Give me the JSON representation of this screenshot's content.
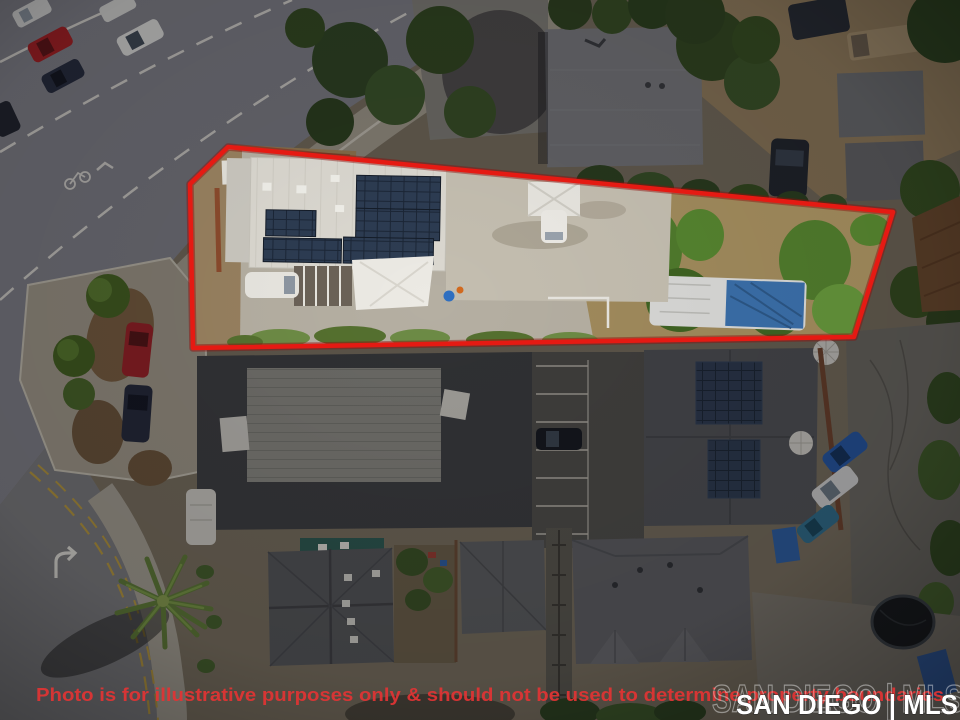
{
  "photo": {
    "description": "Aerial drone view of a commercial property outlined in red",
    "disclaimer": "Photo is for illustrative purposes only & should not be used to determine property boundaries",
    "watermark_solid": "SAN DIEGO | MLS",
    "watermark_ghost": "SAN DIEGO | MLS"
  },
  "boundary": {
    "points": "228,147 893,212 854,337 193,348 190,184"
  },
  "colors": {
    "boundary": "#e51a13",
    "disclaimer": "#e23434",
    "watermark": "#ffffff"
  }
}
